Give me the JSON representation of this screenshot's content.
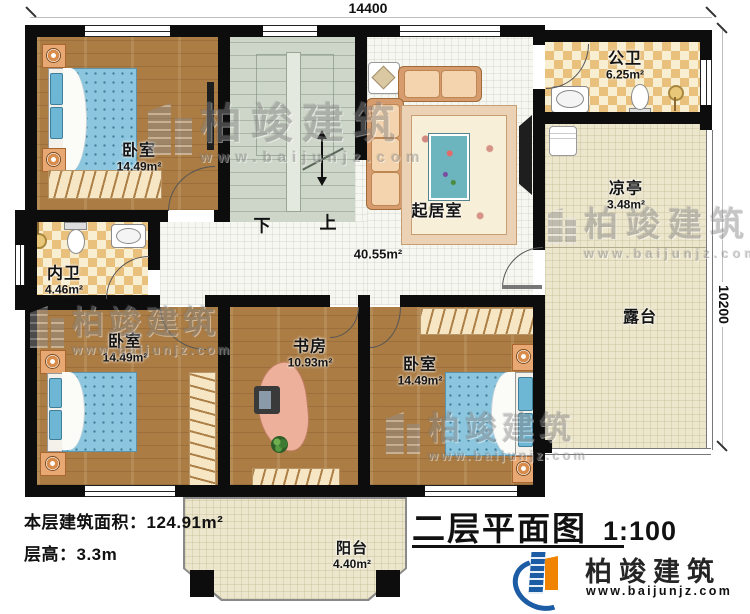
{
  "plan": {
    "dimension_top": "14400",
    "dimension_right": "10200",
    "stairs_down": "下",
    "stairs_up": "上"
  },
  "rooms": {
    "bedroom_top_left": {
      "name": "卧室",
      "area": "14.49m²"
    },
    "bedroom_bottom_left": {
      "name": "卧室",
      "area": "14.49m²"
    },
    "bedroom_bottom_right": {
      "name": "卧室",
      "area": "14.49m²"
    },
    "living_room": {
      "name": "起居室",
      "area": "40.55m²"
    },
    "public_bathroom": {
      "name": "公卫",
      "area": "6.25m²"
    },
    "inner_bathroom": {
      "name": "内卫",
      "area": "4.46m²"
    },
    "study": {
      "name": "书房",
      "area": "10.93m²"
    },
    "pavilion": {
      "name": "凉亭",
      "area": "3.48m²"
    },
    "terrace": {
      "name": "露台"
    },
    "balcony": {
      "name": "阳台",
      "area": "4.40m²"
    }
  },
  "info": {
    "floor_area_label": "本层建筑面积：",
    "floor_area_value": "124.91m²",
    "floor_height_label": "层高：",
    "floor_height_value": "3.3m"
  },
  "titleblock": {
    "title": "二层平面图",
    "scale": "1:100"
  },
  "brand": {
    "name": "柏竣建筑",
    "url": "www.baijunjz.com"
  },
  "watermark": {
    "name": "柏竣建筑",
    "url": "www.baijunjz.com"
  }
}
